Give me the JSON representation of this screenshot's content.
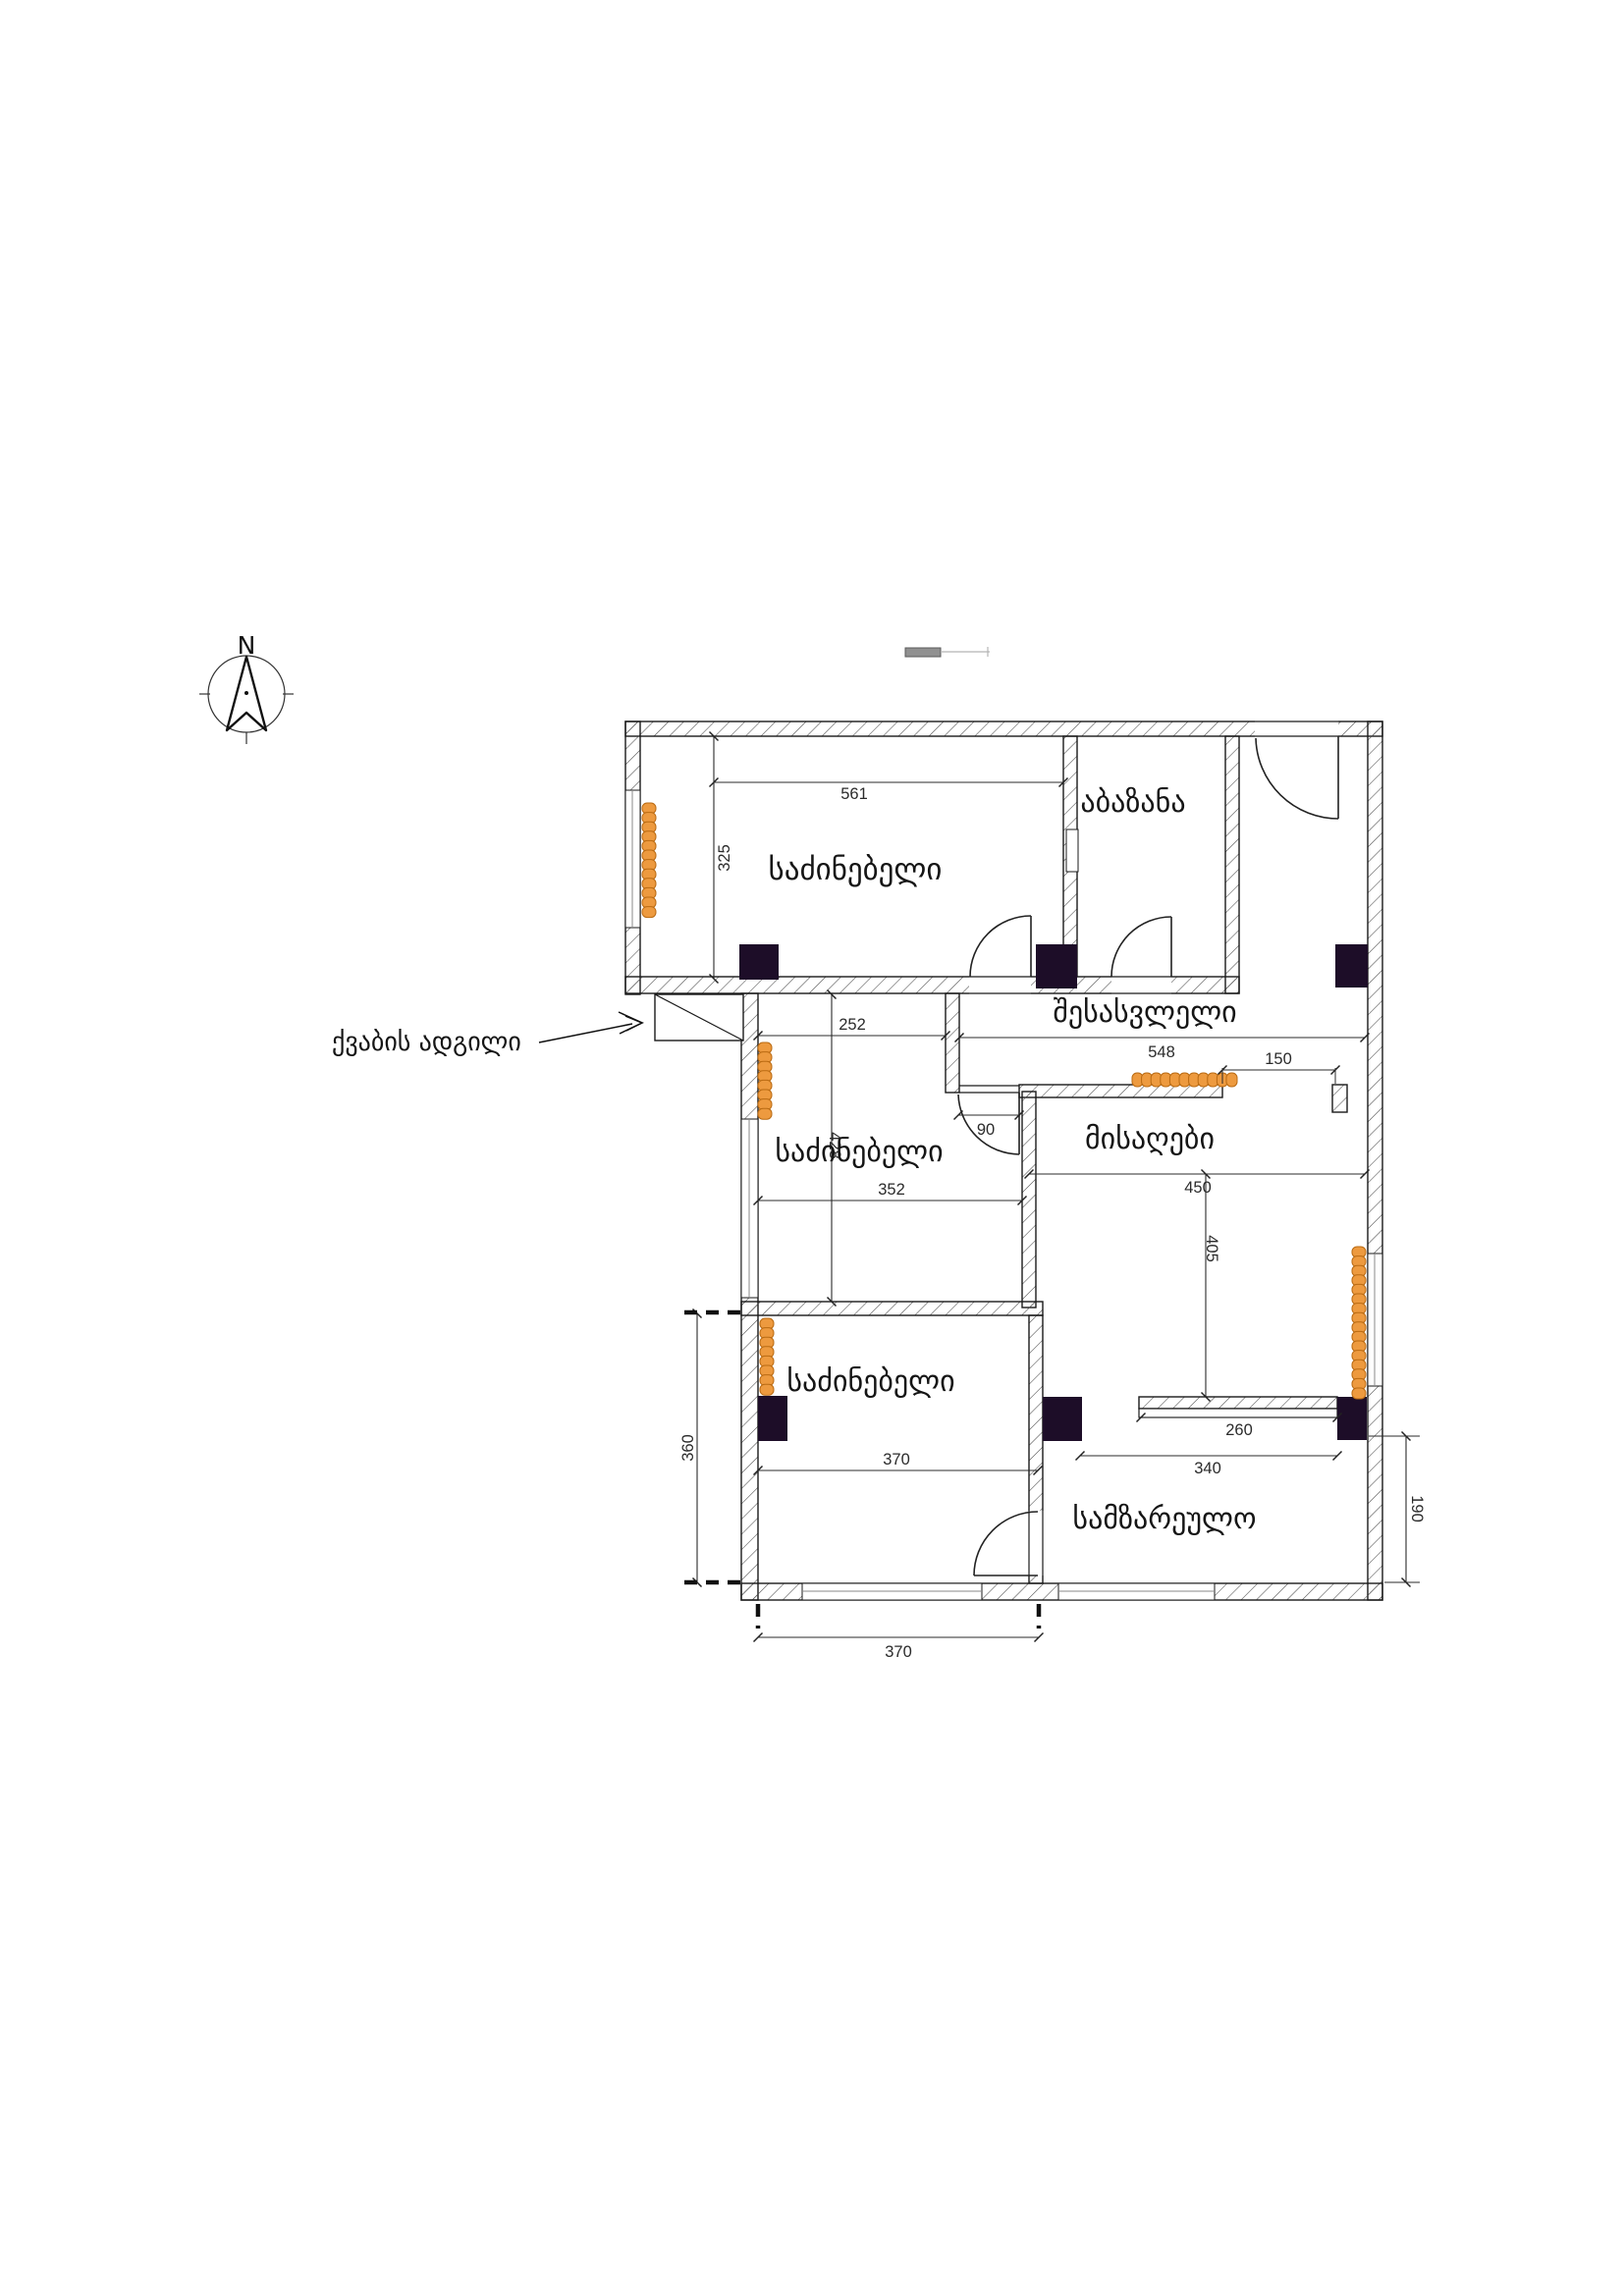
{
  "compass": {
    "north_label": "N"
  },
  "rooms": [
    {
      "id": "bedroom-top",
      "label": "საძინებელი"
    },
    {
      "id": "bathroom",
      "label": "აბაზანა"
    },
    {
      "id": "hall",
      "label": "შესასვლელი"
    },
    {
      "id": "bedroom-middle",
      "label": "საძინებელი"
    },
    {
      "id": "living",
      "label": "მისაღები"
    },
    {
      "id": "bedroom-bottom",
      "label": "საძინებელი"
    },
    {
      "id": "kitchen",
      "label": "სამზარეულო"
    }
  ],
  "dims": {
    "d561": "561",
    "d325": "325",
    "d252": "252",
    "d548": "548",
    "d150": "150",
    "d90": "90",
    "d352": "352",
    "d428": "428",
    "d450": "450",
    "d405": "405",
    "d260": "260",
    "d340": "340",
    "d370_room": "370",
    "d360": "360",
    "d190": "190",
    "d370_bottom": "370"
  },
  "annotations": {
    "boiler_area_label": "ქვაბის ადგილი"
  },
  "colors": {
    "radiator": "#ED9A3F",
    "radiator_border": "#B96A12",
    "column": "#1D0D28",
    "wall_line": "#1A1A1A",
    "dim_text": "#2B2B2B"
  }
}
